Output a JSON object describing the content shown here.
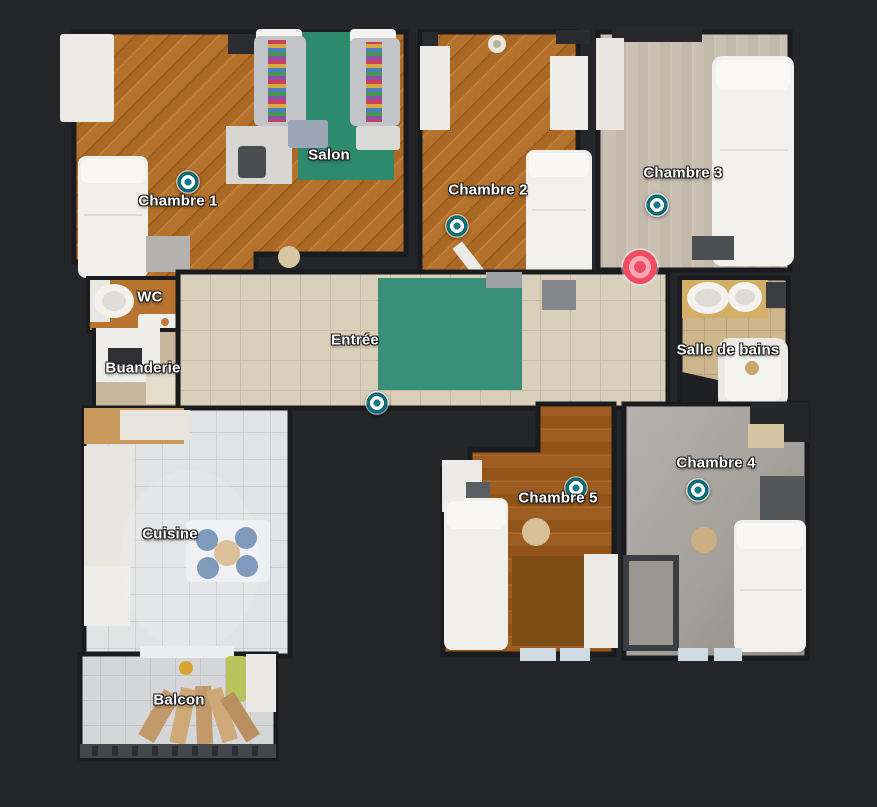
{
  "background_color": "#24262a",
  "floorplan": {
    "rooms": [
      {
        "label": "Chambre 1",
        "x": 178,
        "y": 201
      },
      {
        "label": "Salon",
        "x": 329,
        "y": 155
      },
      {
        "label": "Chambre 2",
        "x": 488,
        "y": 190
      },
      {
        "label": "Chambre 3",
        "x": 683,
        "y": 173
      },
      {
        "label": "WC",
        "x": 150,
        "y": 297
      },
      {
        "label": "Buanderie",
        "x": 143,
        "y": 368
      },
      {
        "label": "Entrée",
        "x": 355,
        "y": 340
      },
      {
        "label": "Salle de bains",
        "x": 728,
        "y": 350
      },
      {
        "label": "Cuisine",
        "x": 170,
        "y": 534
      },
      {
        "label": "Chambre 5",
        "x": 558,
        "y": 498
      },
      {
        "label": "Chambre 4",
        "x": 716,
        "y": 463
      },
      {
        "label": "Balcon",
        "x": 179,
        "y": 700
      }
    ],
    "waypoints": [
      {
        "room": "Chambre 1",
        "x": 188,
        "y": 182
      },
      {
        "room": "Chambre 2",
        "x": 457,
        "y": 226
      },
      {
        "room": "Chambre 3",
        "x": 657,
        "y": 205
      },
      {
        "room": "Entrée",
        "x": 377,
        "y": 403
      },
      {
        "room": "Chambre 5",
        "x": 576,
        "y": 488
      },
      {
        "room": "Chambre 4",
        "x": 698,
        "y": 490
      }
    ],
    "current_position": {
      "x": 640,
      "y": 267
    },
    "colors": {
      "label_text": "#ffffff",
      "label_outline": "#1d1d1d",
      "waypoint": "#0d6b7a",
      "waypoint_center": "#16788a",
      "waypoint_ring": "#ffffff",
      "position": "#ee4d64",
      "position_light": "#f5a8b4"
    }
  }
}
